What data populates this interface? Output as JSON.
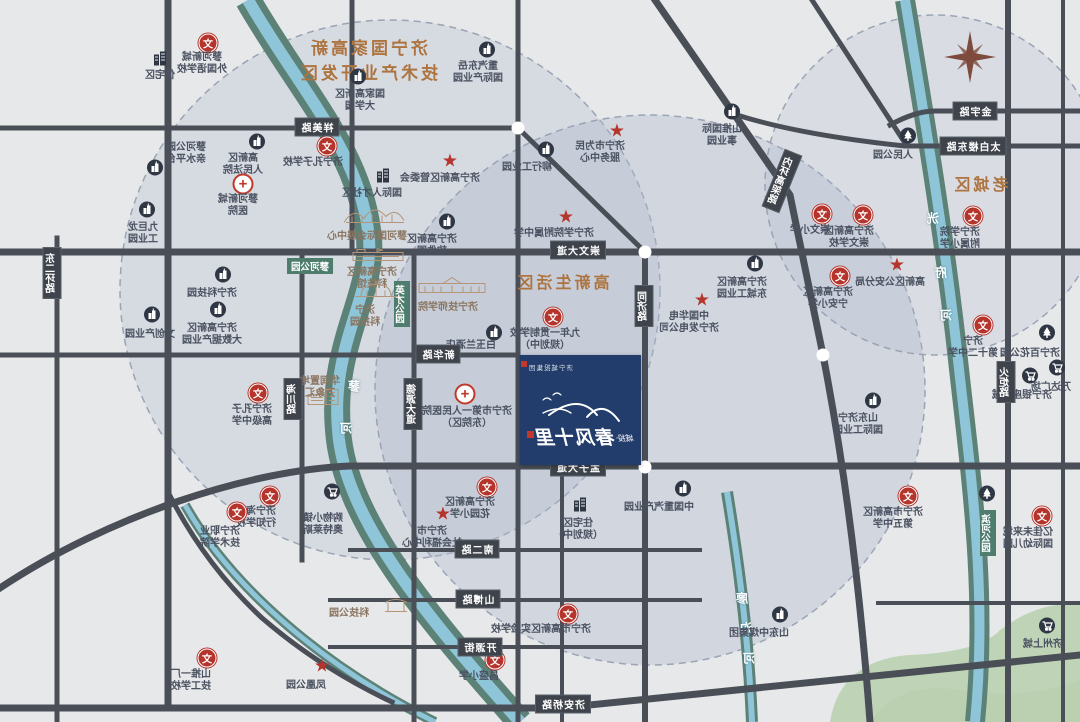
{
  "map_title": "城投·春风十里 区位示意图（镜像）",
  "zones": {
    "dev": {
      "lines": [
        "济宁国家高新",
        "技术产业开发区"
      ],
      "x": 368,
      "y": 34,
      "size": 17
    },
    "living": {
      "text": "高新生活区",
      "x": 562,
      "y": 269,
      "size": 16
    },
    "old": {
      "text": "老城区",
      "x": 980,
      "y": 171,
      "size": 16
    }
  },
  "project": {
    "corp": "济宁城投集团",
    "prefix": "城投",
    "dot": "·",
    "name": "春风十里",
    "x": 520,
    "y": 355,
    "w": 121,
    "h": 110,
    "accent": "#223d6b"
  },
  "compass": {
    "icon": "compass-rose-icon",
    "x": 970,
    "y": 57
  },
  "colors": {
    "road": "#4a4f57",
    "river_bank": "#5c8177",
    "river_water": "#8fc5d8",
    "red": "#b5342c",
    "label": "#4a5160",
    "zone_title": "#ad7440",
    "project_box": "#223d6b",
    "green_area": "#b7cfae",
    "circle_fill": "#aeb9cd"
  },
  "river_labels": [
    {
      "c": "蓼",
      "x": 354,
      "y": 386
    },
    {
      "c": "河",
      "x": 346,
      "y": 428
    },
    {
      "c": "洸",
      "x": 933,
      "y": 218
    },
    {
      "c": "府",
      "x": 941,
      "y": 272
    },
    {
      "c": "河",
      "x": 946,
      "y": 315
    },
    {
      "c": "廖",
      "x": 742,
      "y": 598
    },
    {
      "c": "沟",
      "x": 746,
      "y": 628
    },
    {
      "c": "河",
      "x": 749,
      "y": 658
    }
  ],
  "roads": {
    "labels": [
      {
        "text": "祥美路",
        "x": 317,
        "y": 127
      },
      {
        "text": "崇文大道",
        "x": 578,
        "y": 250
      },
      {
        "text": "金宇路",
        "x": 975,
        "y": 111
      },
      {
        "text": "太白楼东路",
        "x": 973,
        "y": 146
      },
      {
        "text": "孟子大道",
        "x": 578,
        "y": 467
      },
      {
        "text": "新华路",
        "x": 438,
        "y": 354
      },
      {
        "text": "南二路",
        "x": 477,
        "y": 549
      },
      {
        "text": "山博路",
        "x": 478,
        "y": 599
      },
      {
        "text": "开源街",
        "x": 480,
        "y": 647
      },
      {
        "text": "济安桥路",
        "x": 563,
        "y": 704
      },
      {
        "text": "同济路",
        "x": 644,
        "y": 306,
        "v": 1
      },
      {
        "text": "德源大道",
        "x": 413,
        "y": 404,
        "v": 1
      },
      {
        "text": "海川路",
        "x": 293,
        "y": 399,
        "v": 1
      },
      {
        "text": "东二环路",
        "x": 52,
        "y": 273,
        "v": 1
      },
      {
        "text": "火炬路",
        "x": 1006,
        "y": 382,
        "v": 1
      },
      {
        "text": "内环高架路",
        "x": 782,
        "y": 181,
        "v": 1,
        "rot": 22
      }
    ]
  },
  "green_labels": [
    {
      "text": "蓼河公园",
      "x": 310,
      "y": 266
    },
    {
      "text": "英才公园",
      "x": 402,
      "y": 304,
      "v": 1
    },
    {
      "text": "滨河公园",
      "x": 988,
      "y": 533,
      "v": 1
    }
  ],
  "junctions": [
    {
      "x": 518,
      "y": 128
    },
    {
      "x": 645,
      "y": 252
    },
    {
      "x": 645,
      "y": 467
    },
    {
      "x": 823,
      "y": 355
    }
  ],
  "landmarks": [
    {
      "icon": "building-icon",
      "x": 160,
      "y": 60,
      "lx": 160,
      "ly": 70,
      "lines": [
        "住宅区"
      ]
    },
    {
      "icon": "school-icon",
      "x": 208,
      "y": 43,
      "lx": 202,
      "ly": 52,
      "lines": [
        "蓼河新城",
        "外国语学校"
      ]
    },
    {
      "icon": "info-icon",
      "x": 358,
      "y": 79,
      "lx": 360,
      "ly": 89,
      "lines": [
        "国家高新区",
        "大学园"
      ]
    },
    {
      "icon": "info-icon",
      "x": 487,
      "y": 52,
      "lx": 478,
      "ly": 61,
      "lines": [
        "重汽东岳",
        "国际产业园"
      ]
    },
    {
      "icon": "star-icon",
      "x": 617,
      "y": 132,
      "lx": 600,
      "ly": 141,
      "lines": [
        "济宁市为民",
        "服务中心"
      ]
    },
    {
      "icon": "info-icon",
      "x": 732,
      "y": 114,
      "lx": 722,
      "ly": 124,
      "lines": [
        "山推国际",
        "事业园"
      ]
    },
    {
      "icon": "park-icon",
      "x": 908,
      "y": 138,
      "lx": 893,
      "ly": 150,
      "lines": [
        "人民公园"
      ]
    },
    {
      "icon": "info-icon",
      "x": 155,
      "y": 170,
      "lx": 186,
      "ly": 142,
      "lines": [
        "蓼河公园",
        "亲水平台"
      ]
    },
    {
      "icon": "info-icon",
      "x": 257,
      "y": 144,
      "lx": 243,
      "ly": 153,
      "lines": [
        "高新区",
        "人民法院"
      ]
    },
    {
      "icon": "hospital-icon",
      "x": 243,
      "y": 184,
      "lx": 238,
      "ly": 194,
      "lines": [
        "蓼河新城",
        "医院"
      ]
    },
    {
      "icon": "info-icon",
      "x": 147,
      "y": 212,
      "lx": 143,
      "ly": 222,
      "lines": [
        "九巨龙",
        "工业园"
      ]
    },
    {
      "icon": "school-icon",
      "x": 327,
      "y": 146,
      "lx": 313,
      "ly": 157,
      "lines": [
        "济宁孔子学校"
      ]
    },
    {
      "icon": "building-icon",
      "x": 383,
      "y": 177,
      "lx": 372,
      "ly": 188,
      "lines": [
        "国际人才社区"
      ]
    },
    {
      "icon": "drawing-expo-icon",
      "x": 374,
      "y": 216,
      "lx": 367,
      "ly": 231,
      "lines": [
        "蓼河国际会展中心"
      ],
      "tone": "tan"
    },
    {
      "icon": "star-icon",
      "x": 450,
      "y": 162,
      "lx": 440,
      "ly": 173,
      "lines": [
        "济宁高新区管委会"
      ]
    },
    {
      "icon": "info-icon",
      "x": 546,
      "y": 152,
      "lx": 527,
      "ly": 162,
      "lines": [
        "柳行工业园"
      ]
    },
    {
      "icon": "star-icon",
      "x": 566,
      "y": 218,
      "lx": 554,
      "ly": 228,
      "lines": [
        "济宁学院附属中学"
      ]
    },
    {
      "icon": "info-icon",
      "x": 447,
      "y": 224,
      "lx": 432,
      "ly": 234,
      "lines": [
        "济宁高新区",
        "软件园"
      ]
    },
    {
      "icon": "drawing-flat-icon",
      "x": 378,
      "y": 257,
      "lx": 372,
      "ly": 267,
      "lines": [
        "济宁高新区",
        "科技馆"
      ],
      "tone": "tan"
    },
    {
      "icon": "drawing-dome-icon",
      "x": 376,
      "y": 292,
      "lx": 365,
      "ly": 305,
      "lines": [
        "济宁",
        "科技园"
      ],
      "tone": "tan"
    },
    {
      "icon": "drawing-college-icon",
      "x": 452,
      "y": 288,
      "lx": 448,
      "ly": 302,
      "lines": [
        "济宁技师学院"
      ],
      "tone": "tan"
    },
    {
      "icon": "info-icon",
      "x": 494,
      "y": 335,
      "lx": 471,
      "ly": 340,
      "lines": [
        "白玉兰酒店"
      ]
    },
    {
      "icon": "info-icon",
      "x": 223,
      "y": 277,
      "lx": 212,
      "ly": 288,
      "lines": [
        "济宁科技园"
      ]
    },
    {
      "icon": "info-icon",
      "x": 218,
      "y": 312,
      "lx": 212,
      "ly": 323,
      "lines": [
        "济宁高新区",
        "大数据产业园"
      ]
    },
    {
      "icon": "info-icon",
      "x": 152,
      "y": 317,
      "lx": 150,
      "ly": 329,
      "lines": [
        "文创产业园"
      ]
    },
    {
      "icon": "school-icon",
      "x": 258,
      "y": 393,
      "lx": 252,
      "ly": 404,
      "lines": [
        "济宁孔子",
        "高级中学"
      ]
    },
    {
      "icon": "drawing-mall-icon",
      "x": 323,
      "y": 399,
      "lx": 320,
      "ly": 376,
      "lines": [
        "华润置地",
        "万象汇"
      ],
      "tone": "tan"
    },
    {
      "icon": "hospital-icon",
      "x": 465,
      "y": 394,
      "lx": 467,
      "ly": 406,
      "lines": [
        "济宁市第一人民医院",
        "（东院区）"
      ]
    },
    {
      "icon": "school-icon",
      "x": 553,
      "y": 317,
      "lx": 545,
      "ly": 328,
      "lines": [
        "九年一贯制学校",
        "（规划中）"
      ]
    },
    {
      "icon": "star-icon",
      "x": 702,
      "y": 301,
      "lx": 689,
      "ly": 311,
      "lines": [
        "中国华电",
        "济宁发电公司"
      ]
    },
    {
      "icon": "info-icon",
      "x": 755,
      "y": 266,
      "lx": 742,
      "ly": 277,
      "lines": [
        "济宁高新区",
        "东城工业园"
      ]
    },
    {
      "icon": "building-icon",
      "x": 580,
      "y": 506,
      "lx": 578,
      "ly": 518,
      "lines": [
        "住宅区",
        "（规划中）"
      ]
    },
    {
      "icon": "school-icon",
      "x": 487,
      "y": 487,
      "lx": 470,
      "ly": 497,
      "lines": [
        "济宁高新区",
        "花园小学"
      ]
    },
    {
      "icon": "star-icon",
      "x": 443,
      "y": 515,
      "lx": 432,
      "ly": 526,
      "lines": [
        "济宁市",
        "社会福利中心"
      ]
    },
    {
      "icon": "cart-icon",
      "x": 332,
      "y": 494,
      "lx": 323,
      "ly": 513,
      "lines": [
        "购物小镇",
        "奥特莱斯"
      ]
    },
    {
      "icon": "school-icon",
      "x": 270,
      "y": 496,
      "lx": 256,
      "ly": 506,
      "lines": [
        "济宁海达",
        "行知学校"
      ]
    },
    {
      "icon": "school-icon",
      "x": 237,
      "y": 512,
      "lx": 220,
      "ly": 526,
      "lines": [
        "济宁职业",
        "技术学院"
      ]
    },
    {
      "icon": "school-icon",
      "x": 568,
      "y": 614,
      "lx": 541,
      "ly": 624,
      "lines": [
        "济宁市高新区实验学校"
      ]
    },
    {
      "icon": "school-icon",
      "x": 495,
      "y": 660,
      "lx": 479,
      "ly": 671,
      "lines": [
        "昌盛小学"
      ]
    },
    {
      "icon": "school-icon",
      "x": 207,
      "y": 658,
      "lx": 191,
      "ly": 669,
      "lines": [
        "山推一厂",
        "技工学校"
      ]
    },
    {
      "icon": "star-icon",
      "x": 322,
      "y": 667,
      "lx": 306,
      "ly": 680,
      "lines": [
        "凤凰公园"
      ]
    },
    {
      "icon": "drawing-gate-icon",
      "x": 396,
      "y": 608,
      "lx": 349,
      "ly": 608,
      "lines": [
        "科技公园"
      ],
      "tone": "tan"
    },
    {
      "icon": "info-icon",
      "x": 683,
      "y": 491,
      "lx": 659,
      "ly": 502,
      "lines": [
        "中国重汽产业园"
      ]
    },
    {
      "icon": "info-icon",
      "x": 780,
      "y": 617,
      "lx": 759,
      "ly": 628,
      "lines": [
        "山东中煤集团"
      ]
    },
    {
      "icon": "info-icon",
      "x": 873,
      "y": 403,
      "lx": 858,
      "ly": 413,
      "lines": [
        "山东济宁",
        "国际工业园"
      ]
    },
    {
      "icon": "school-icon",
      "x": 908,
      "y": 496,
      "lx": 893,
      "ly": 507,
      "lines": [
        "济宁市高新区",
        "第五中学"
      ]
    },
    {
      "icon": "park-icon",
      "x": 987,
      "y": 496,
      "lx": 987,
      "ly": 496,
      "lines": []
    },
    {
      "icon": "school-icon",
      "x": 1042,
      "y": 516,
      "lx": 1028,
      "ly": 527,
      "lines": [
        "亿佳未来城",
        "国际幼儿园"
      ]
    },
    {
      "icon": "cart-icon",
      "x": 1047,
      "y": 628,
      "lx": 1043,
      "ly": 639,
      "lines": [
        "济州上城"
      ]
    },
    {
      "icon": "school-icon",
      "x": 822,
      "y": 214,
      "lx": 810,
      "ly": 225,
      "lines": [
        "崇文小学"
      ]
    },
    {
      "icon": "school-icon",
      "x": 863,
      "y": 215,
      "lx": 849,
      "ly": 226,
      "lines": [
        "济宁高新区",
        "崇文学校"
      ]
    },
    {
      "icon": "school-icon",
      "x": 973,
      "y": 216,
      "lx": 960,
      "ly": 227,
      "lines": [
        "济宁学院",
        "附属小学"
      ]
    },
    {
      "icon": "star-icon",
      "x": 897,
      "y": 266,
      "lx": 890,
      "ly": 277,
      "lines": [
        "高新区公安分局"
      ]
    },
    {
      "icon": "school-icon",
      "x": 840,
      "y": 276,
      "lx": 828,
      "ly": 287,
      "lines": [
        "济宁高新区",
        "宁安小学"
      ]
    },
    {
      "icon": "school-icon",
      "x": 983,
      "y": 325,
      "lx": 973,
      "ly": 336,
      "lines": [
        "济宁",
        "第十二中学"
      ]
    },
    {
      "icon": "park-icon",
      "x": 1047,
      "y": 335,
      "lx": 1030,
      "ly": 348,
      "lines": [
        "济宁百花公园"
      ]
    },
    {
      "icon": "cart-icon",
      "x": 1030,
      "y": 378,
      "lx": 1022,
      "ly": 390,
      "lines": [
        "济宁银座商城"
      ]
    },
    {
      "icon": "cart-icon",
      "x": 1057,
      "y": 370,
      "lx": 1051,
      "ly": 382,
      "lines": [
        "万达广场"
      ]
    }
  ]
}
